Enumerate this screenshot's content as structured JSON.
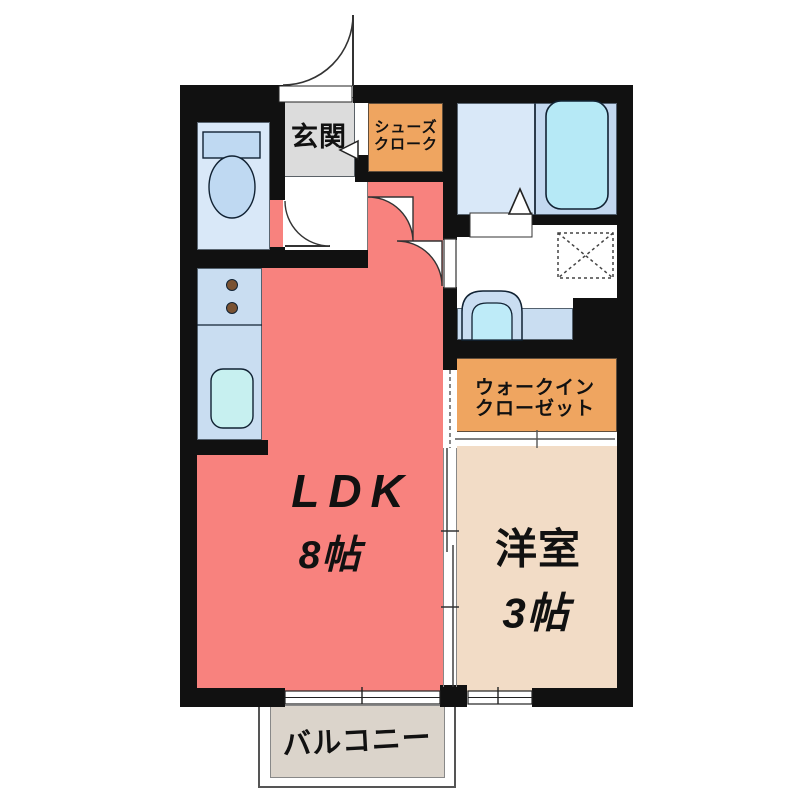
{
  "plan_title": "1LDK apartment floor plan",
  "labels": {
    "genkan": "玄関",
    "shoes_cloak": [
      "シューズ",
      "クローク"
    ],
    "ldk": "LDK",
    "ldk_size": "8帖",
    "wic": [
      "ウォークイン",
      "クローゼット"
    ],
    "western_room": "洋室",
    "western_room_size": "3帖",
    "balcony": "バルコニー"
  },
  "rooms": [
    {
      "name": "genkan",
      "label": "玄関"
    },
    {
      "name": "shoes-cloak",
      "label": "シューズクローク"
    },
    {
      "name": "toilet",
      "label": ""
    },
    {
      "name": "bathroom",
      "label": ""
    },
    {
      "name": "washroom",
      "label": ""
    },
    {
      "name": "kitchen",
      "label": ""
    },
    {
      "name": "ldk",
      "label": "LDK 8帖"
    },
    {
      "name": "walk-in-closet",
      "label": "ウォークインクローゼット"
    },
    {
      "name": "western-room",
      "label": "洋室 3帖"
    },
    {
      "name": "balcony",
      "label": "バルコニー"
    }
  ],
  "fixtures": [
    "entrance-door",
    "toilet",
    "kitchen-sink",
    "stove-burners",
    "bathtub",
    "washbasin",
    "washing-machine-space",
    "folding-bath-door",
    "sliding-doors",
    "windows",
    "entry-step-arrow"
  ],
  "colors": {
    "wall": "#111111",
    "ldk": "#F8827E",
    "genkan": "#DCDCDC",
    "closet_orange": "#EFA560",
    "western_beige": "#F2DCC6",
    "sanitary_blue": "#D9E8F8",
    "kitchen_blue": "#C9DDF1",
    "bath_panel": "#C3D8EF",
    "tub_fill": "#B6E9F6",
    "sink_fill": "#C7F0F0",
    "basin_fill": "#BEEBF8",
    "fixture_blue": "#BFD9F2",
    "burner_brown": "#7A5232",
    "balcony_gray": "#DBD4CB",
    "text": "#111111"
  }
}
